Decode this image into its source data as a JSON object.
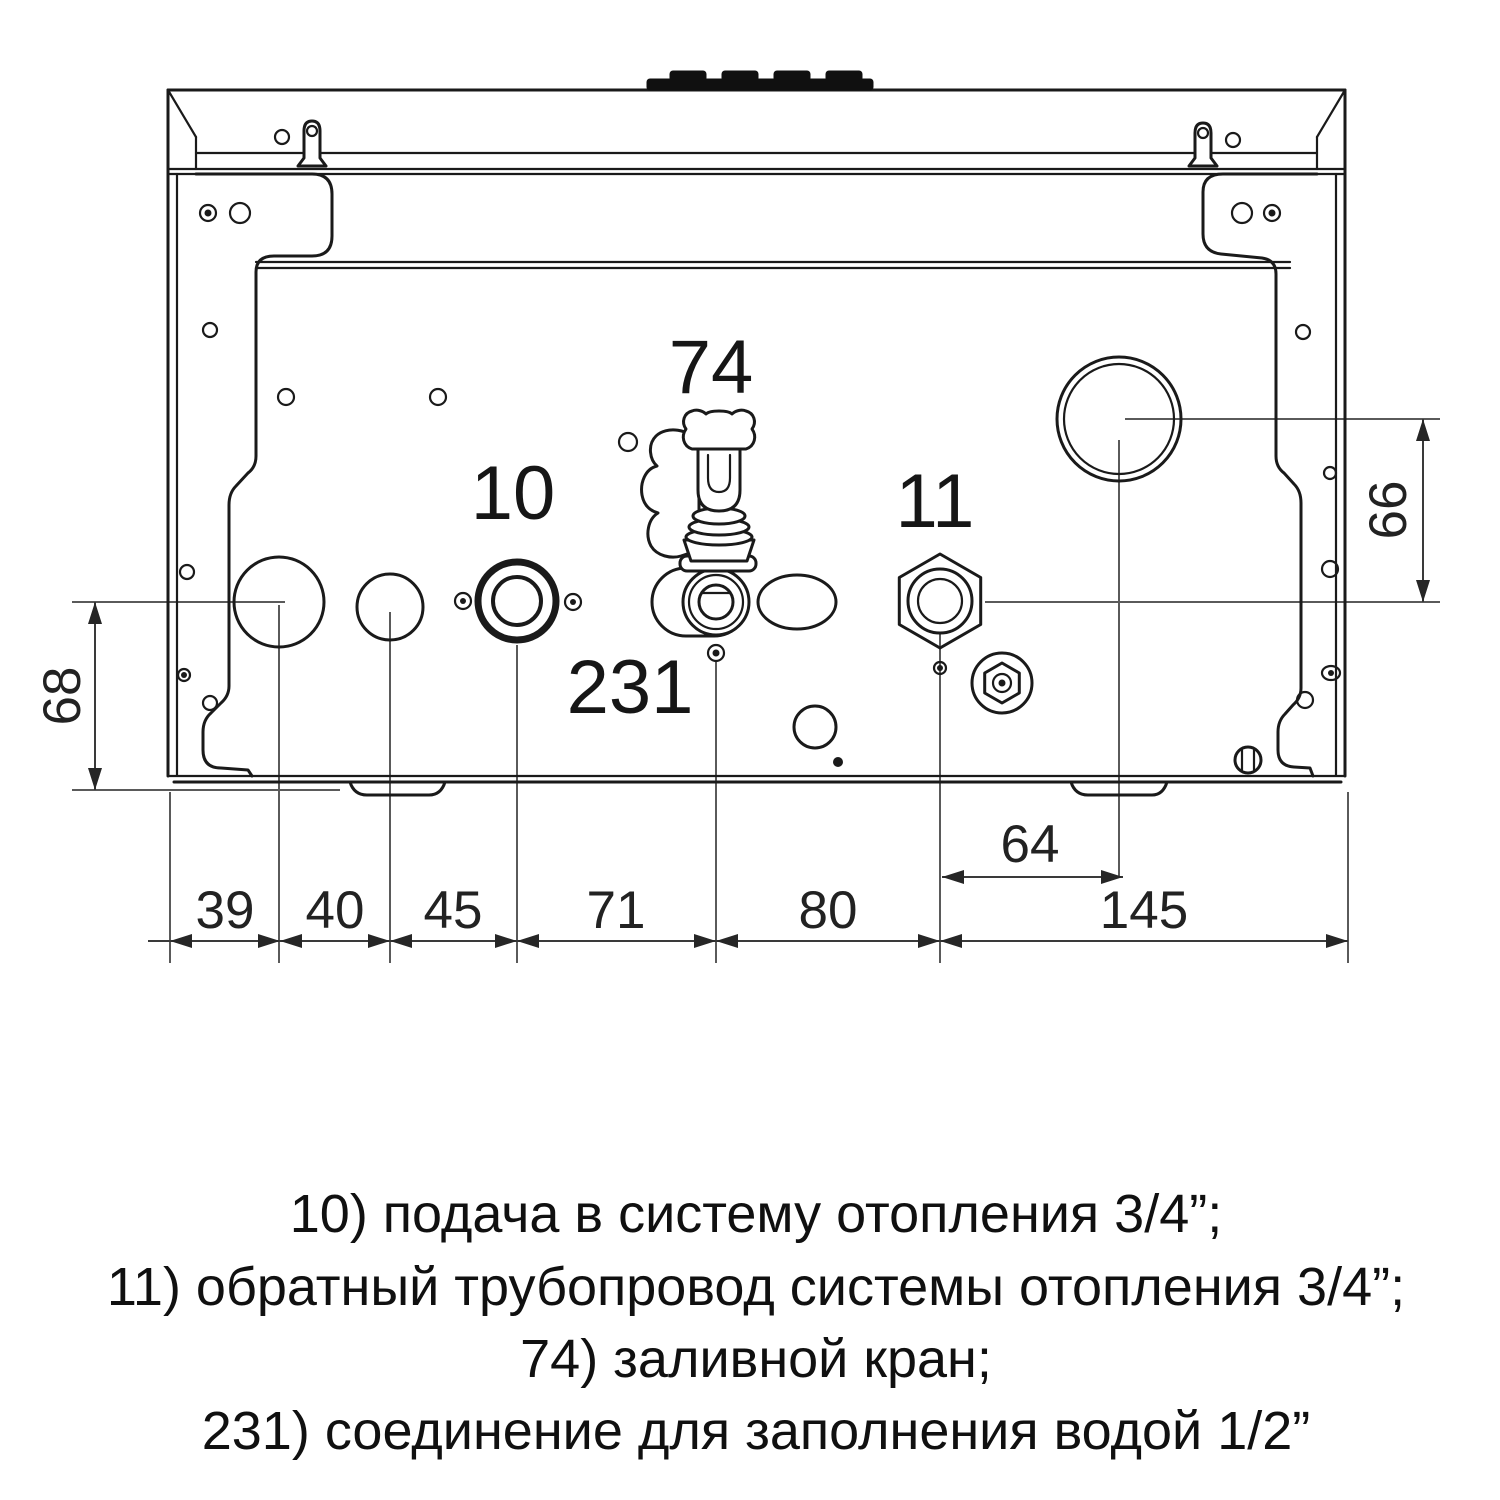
{
  "diagram": {
    "part_labels": {
      "heating_supply": "10",
      "heating_return": "11",
      "fill_valve": "74",
      "water_fill": "231"
    },
    "dimensions": {
      "left_height": "68",
      "right_height": "66",
      "circle_offset": "64",
      "bottom_chain": [
        "39",
        "40",
        "45",
        "71",
        "80",
        "145"
      ]
    },
    "legend_lines": [
      "10) подача в систему отопления 3/4”;",
      "11) обратный трубопровод системы отопления 3/4”;",
      "74) заливной кран;",
      "231) соединение для заполнения водой 1/2”"
    ],
    "colors": {
      "line": "#1a1a1a",
      "dimension": "#3a3a3a",
      "background": "#ffffff"
    }
  }
}
